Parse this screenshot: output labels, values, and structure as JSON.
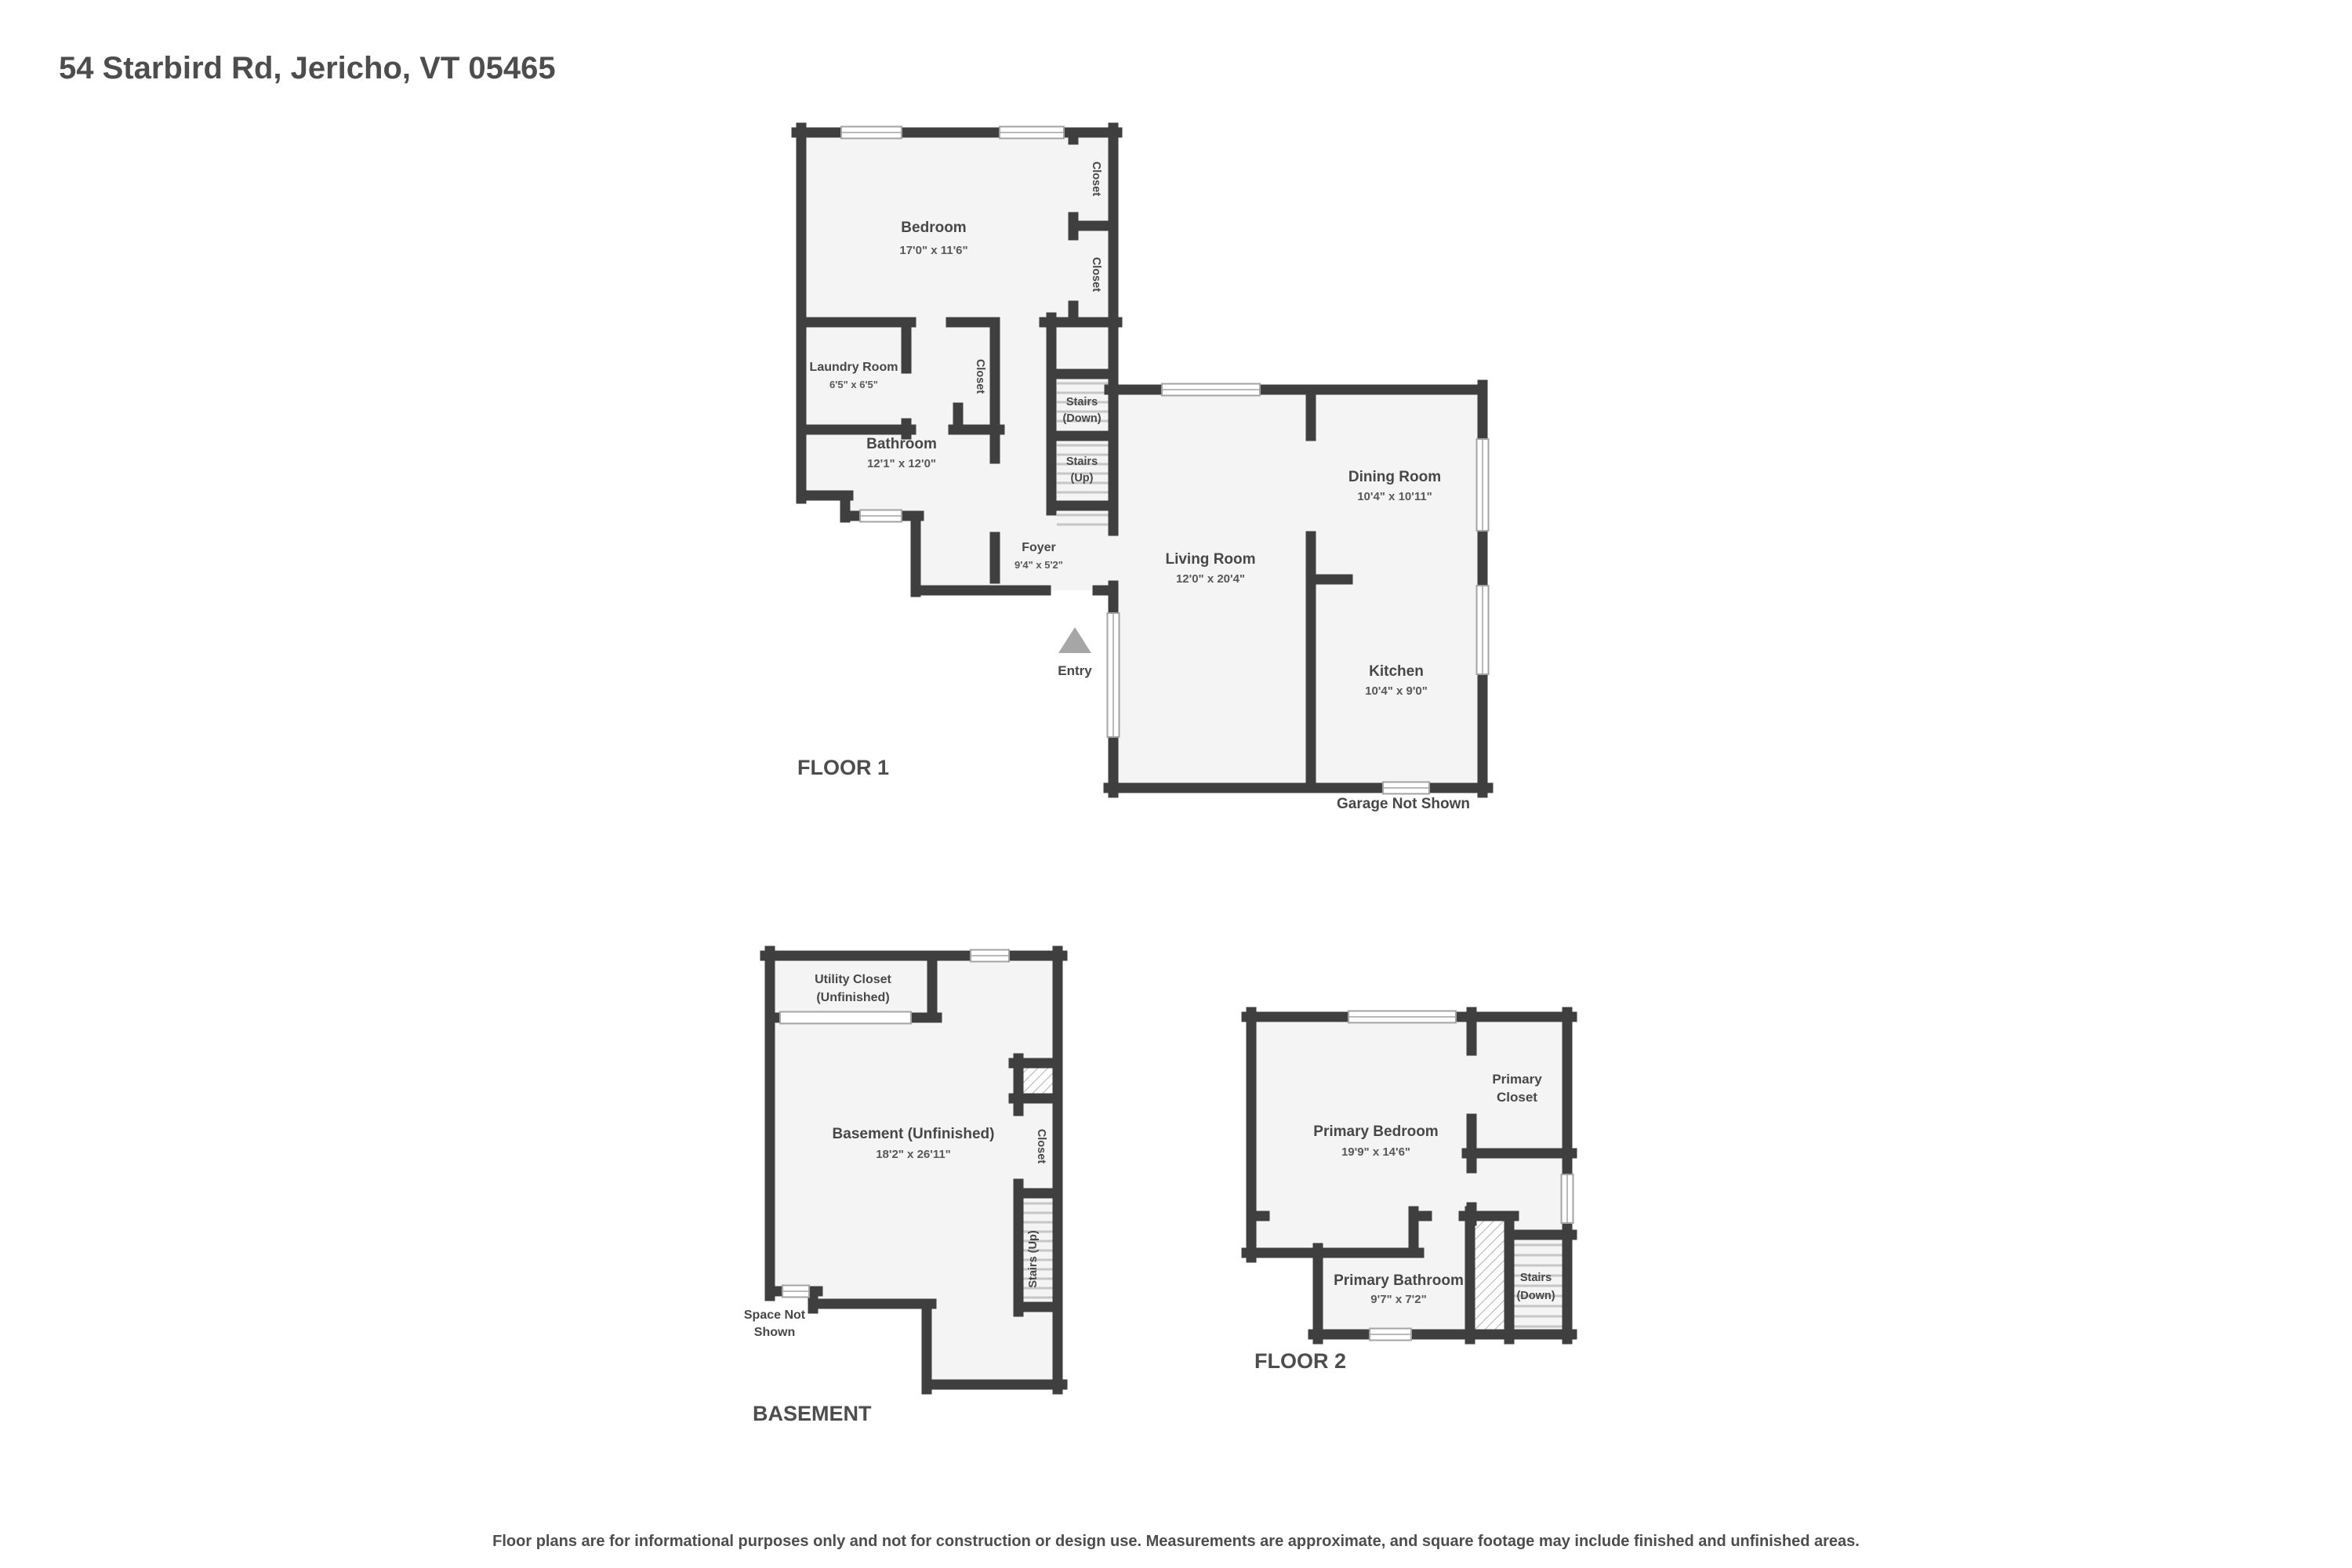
{
  "colors": {
    "wall": "#3f3f3f",
    "room_fill": "#f4f4f4",
    "text": "#474747",
    "entry_arrow": "#a6a6a6"
  },
  "header": {
    "title": "54 Starbird Rd, Jericho, VT 05465"
  },
  "floor1": {
    "label": "FLOOR 1",
    "rooms": {
      "bedroom": {
        "name": "Bedroom",
        "dims": "17'0\" x 11'6\""
      },
      "closet_top": {
        "name": "Closet"
      },
      "closet_bottom": {
        "name": "Closet"
      },
      "laundry": {
        "name": "Laundry Room",
        "dims": "6'5\" x 6'5\""
      },
      "closet_hall": {
        "name": "Closet"
      },
      "bathroom": {
        "name": "Bathroom",
        "dims": "12'1\" x 12'0\""
      },
      "stairs_down": {
        "line1": "Stairs",
        "line2": "(Down)"
      },
      "stairs_up": {
        "line1": "Stairs",
        "line2": "(Up)"
      },
      "foyer": {
        "name": "Foyer",
        "dims": "9'4\" x 5'2\""
      },
      "living": {
        "name": "Living Room",
        "dims": "12'0\" x 20'4\""
      },
      "dining": {
        "name": "Dining Room",
        "dims": "10'4\" x 10'11\""
      },
      "kitchen": {
        "name": "Kitchen",
        "dims": "10'4\" x 9'0\""
      }
    },
    "entry_label": "Entry",
    "garage_note": "Garage Not Shown"
  },
  "basement": {
    "label": "BASEMENT",
    "rooms": {
      "utility": {
        "line1": "Utility Closet",
        "line2": "(Unfinished)"
      },
      "main": {
        "name": "Basement (Unfinished)",
        "dims": "18'2\" x 26'11\""
      },
      "closet": {
        "name": "Closet"
      },
      "stairs_up": {
        "name": "Stairs (Up)"
      }
    },
    "space_note": {
      "line1": "Space Not",
      "line2": "Shown"
    }
  },
  "floor2": {
    "label": "FLOOR 2",
    "rooms": {
      "primary_bedroom": {
        "name": "Primary Bedroom",
        "dims": "19'9\" x 14'6\""
      },
      "primary_closet": {
        "line1": "Primary",
        "line2": "Closet"
      },
      "primary_bathroom": {
        "name": "Primary Bathroom",
        "dims": "9'7\" x 7'2\""
      },
      "stairs_down": {
        "line1": "Stairs",
        "line2": "(Down)"
      }
    }
  },
  "footer": {
    "disclaimer": "Floor plans are for informational purposes only and not for construction or design use. Measurements are approximate, and square footage may include finished and unfinished areas."
  }
}
